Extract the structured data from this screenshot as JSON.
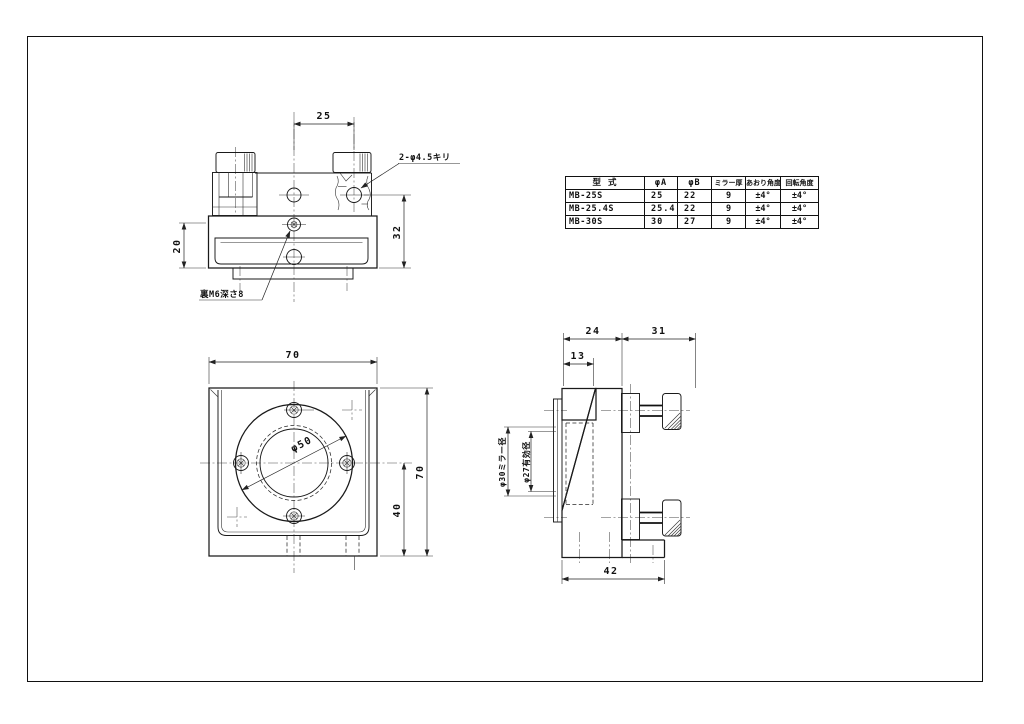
{
  "top_view": {
    "dim_25": "25",
    "dim_20": "20",
    "dim_32": "32",
    "note_drill": "2-φ4.5キリ",
    "note_tap": "裏M6深さ8"
  },
  "spec_table": {
    "headers": [
      "型 式",
      "φA",
      "φB",
      "ミラー厚",
      "あおり角度",
      "回転角度"
    ],
    "rows": [
      [
        "MB-25S",
        "25",
        "22",
        "9",
        "±4°",
        "±4°"
      ],
      [
        "MB-25.4S",
        "25.4",
        "22",
        "9",
        "±4°",
        "±4°"
      ],
      [
        "MB-30S",
        "30",
        "27",
        "9",
        "±4°",
        "±4°"
      ]
    ]
  },
  "front_view": {
    "dim_width": "70",
    "dim_height": "70",
    "dim_40": "40",
    "dim_phi50": "φ50"
  },
  "side_view": {
    "dim_24": "24",
    "dim_31": "31",
    "dim_13": "13",
    "dim_42": "42",
    "label_mirror": "φ30ミラー径",
    "label_effective": "φ27有効径"
  }
}
